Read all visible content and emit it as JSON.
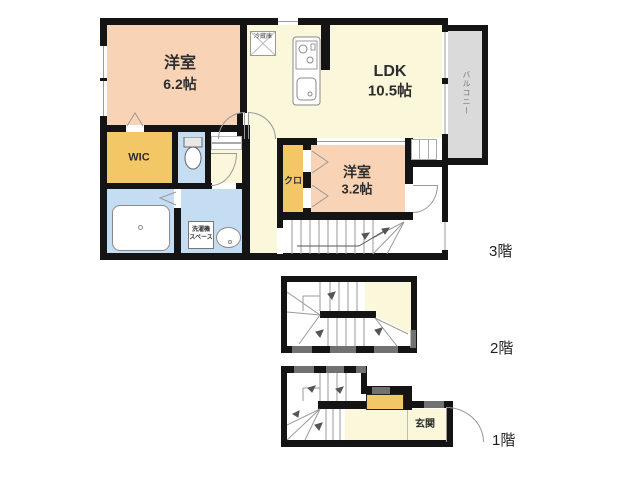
{
  "colors": {
    "wall": "#141414",
    "peach": "#f9d3b5",
    "cream": "#faf7da",
    "orange": "#f3c765",
    "blue": "#c5ddf2",
    "balconygray": "#dadada",
    "line": "#999999"
  },
  "floor3": {
    "label": "3階",
    "western_room_large": {
      "name": "洋室",
      "size": "6.2帖"
    },
    "ldk": {
      "name": "LDK",
      "size": "10.5帖"
    },
    "western_room_small": {
      "name": "洋室",
      "size": "3.2帖"
    },
    "wic": "WIC",
    "closet": "クロ",
    "balcony": "バルコニー",
    "refrigerator": "冷蔵庫",
    "laundry_space": [
      "洗濯機",
      "スペース"
    ]
  },
  "floor2": {
    "label": "2階"
  },
  "floor1": {
    "label": "1階",
    "entrance": "玄関"
  }
}
